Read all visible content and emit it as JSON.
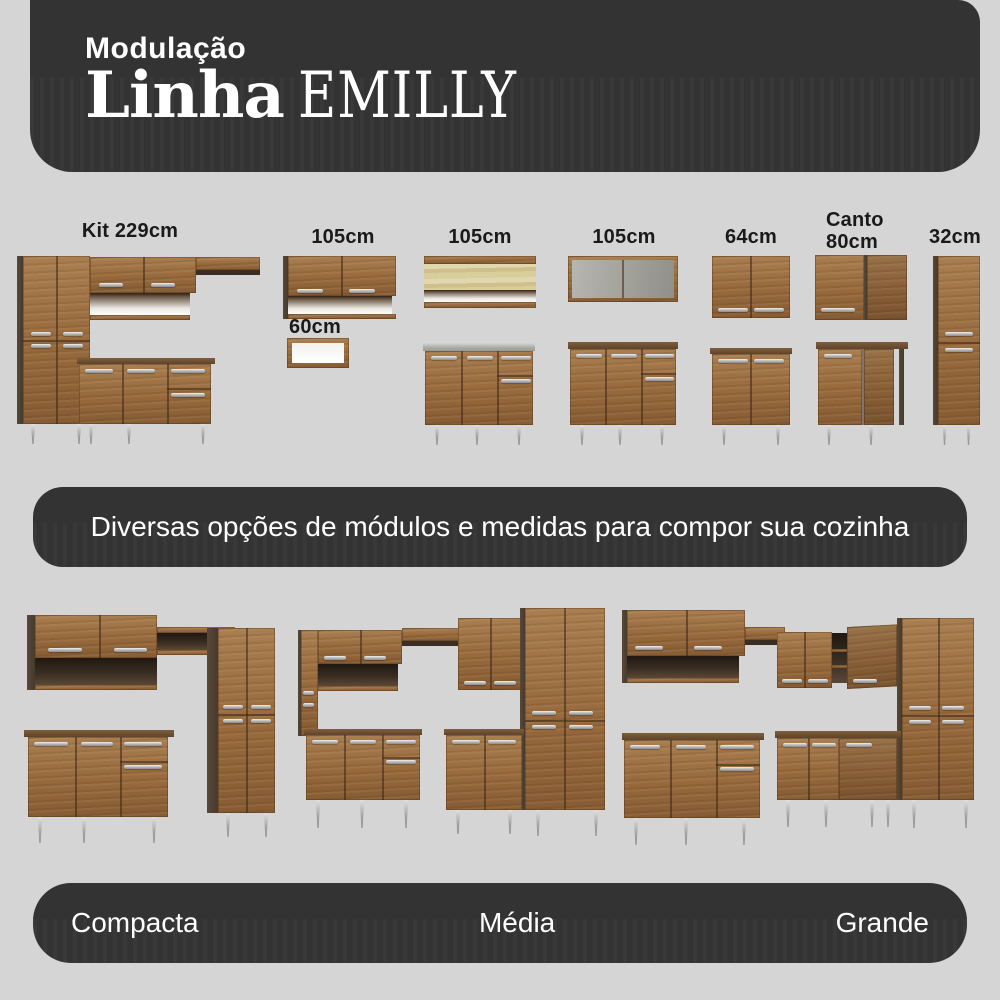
{
  "header": {
    "eyebrow": "Modulação",
    "title": "Linha",
    "title_accent": "EMILLY"
  },
  "modules": {
    "items": [
      {
        "label": "Kit 229cm"
      },
      {
        "label": "105cm"
      },
      {
        "label": "60cm"
      },
      {
        "label": "105cm"
      },
      {
        "label": "105cm"
      },
      {
        "label": "64cm"
      },
      {
        "label": "Canto",
        "label2": "80cm"
      },
      {
        "label": "32cm"
      }
    ]
  },
  "subtitle": {
    "text": "Diversas opções de módulos e medidas para compor sua cozinha"
  },
  "kitchens": {
    "items": [
      {
        "label": "Compacta"
      },
      {
        "label": "Média"
      },
      {
        "label": "Grande"
      }
    ]
  },
  "colors": {
    "background": "#d5d5d5",
    "banner": "#333333",
    "banner_text": "#ffffff",
    "label_text": "#1a1a1a",
    "wood": "#9a6c3f",
    "wood_dark": "#4c3e33",
    "handle": "#c9c9c9",
    "leg": "#b9bab8",
    "pine": "#d6c993",
    "glass": "#a6a69e",
    "sink": "#b8bcb8"
  }
}
